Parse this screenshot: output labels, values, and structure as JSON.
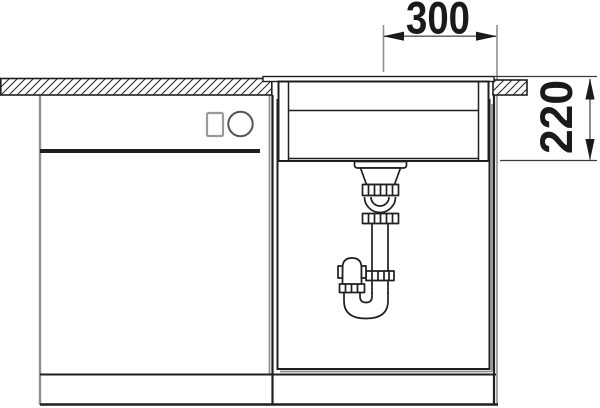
{
  "drawing_type": "sink-installation-front-section",
  "annotations": {
    "width_dimension": "300",
    "depth_dimension": "220"
  },
  "colors": {
    "line": "#1f1f1f",
    "shadow": "#8f8f8f",
    "dimension_line": "#555555",
    "background": "#ffffff"
  }
}
